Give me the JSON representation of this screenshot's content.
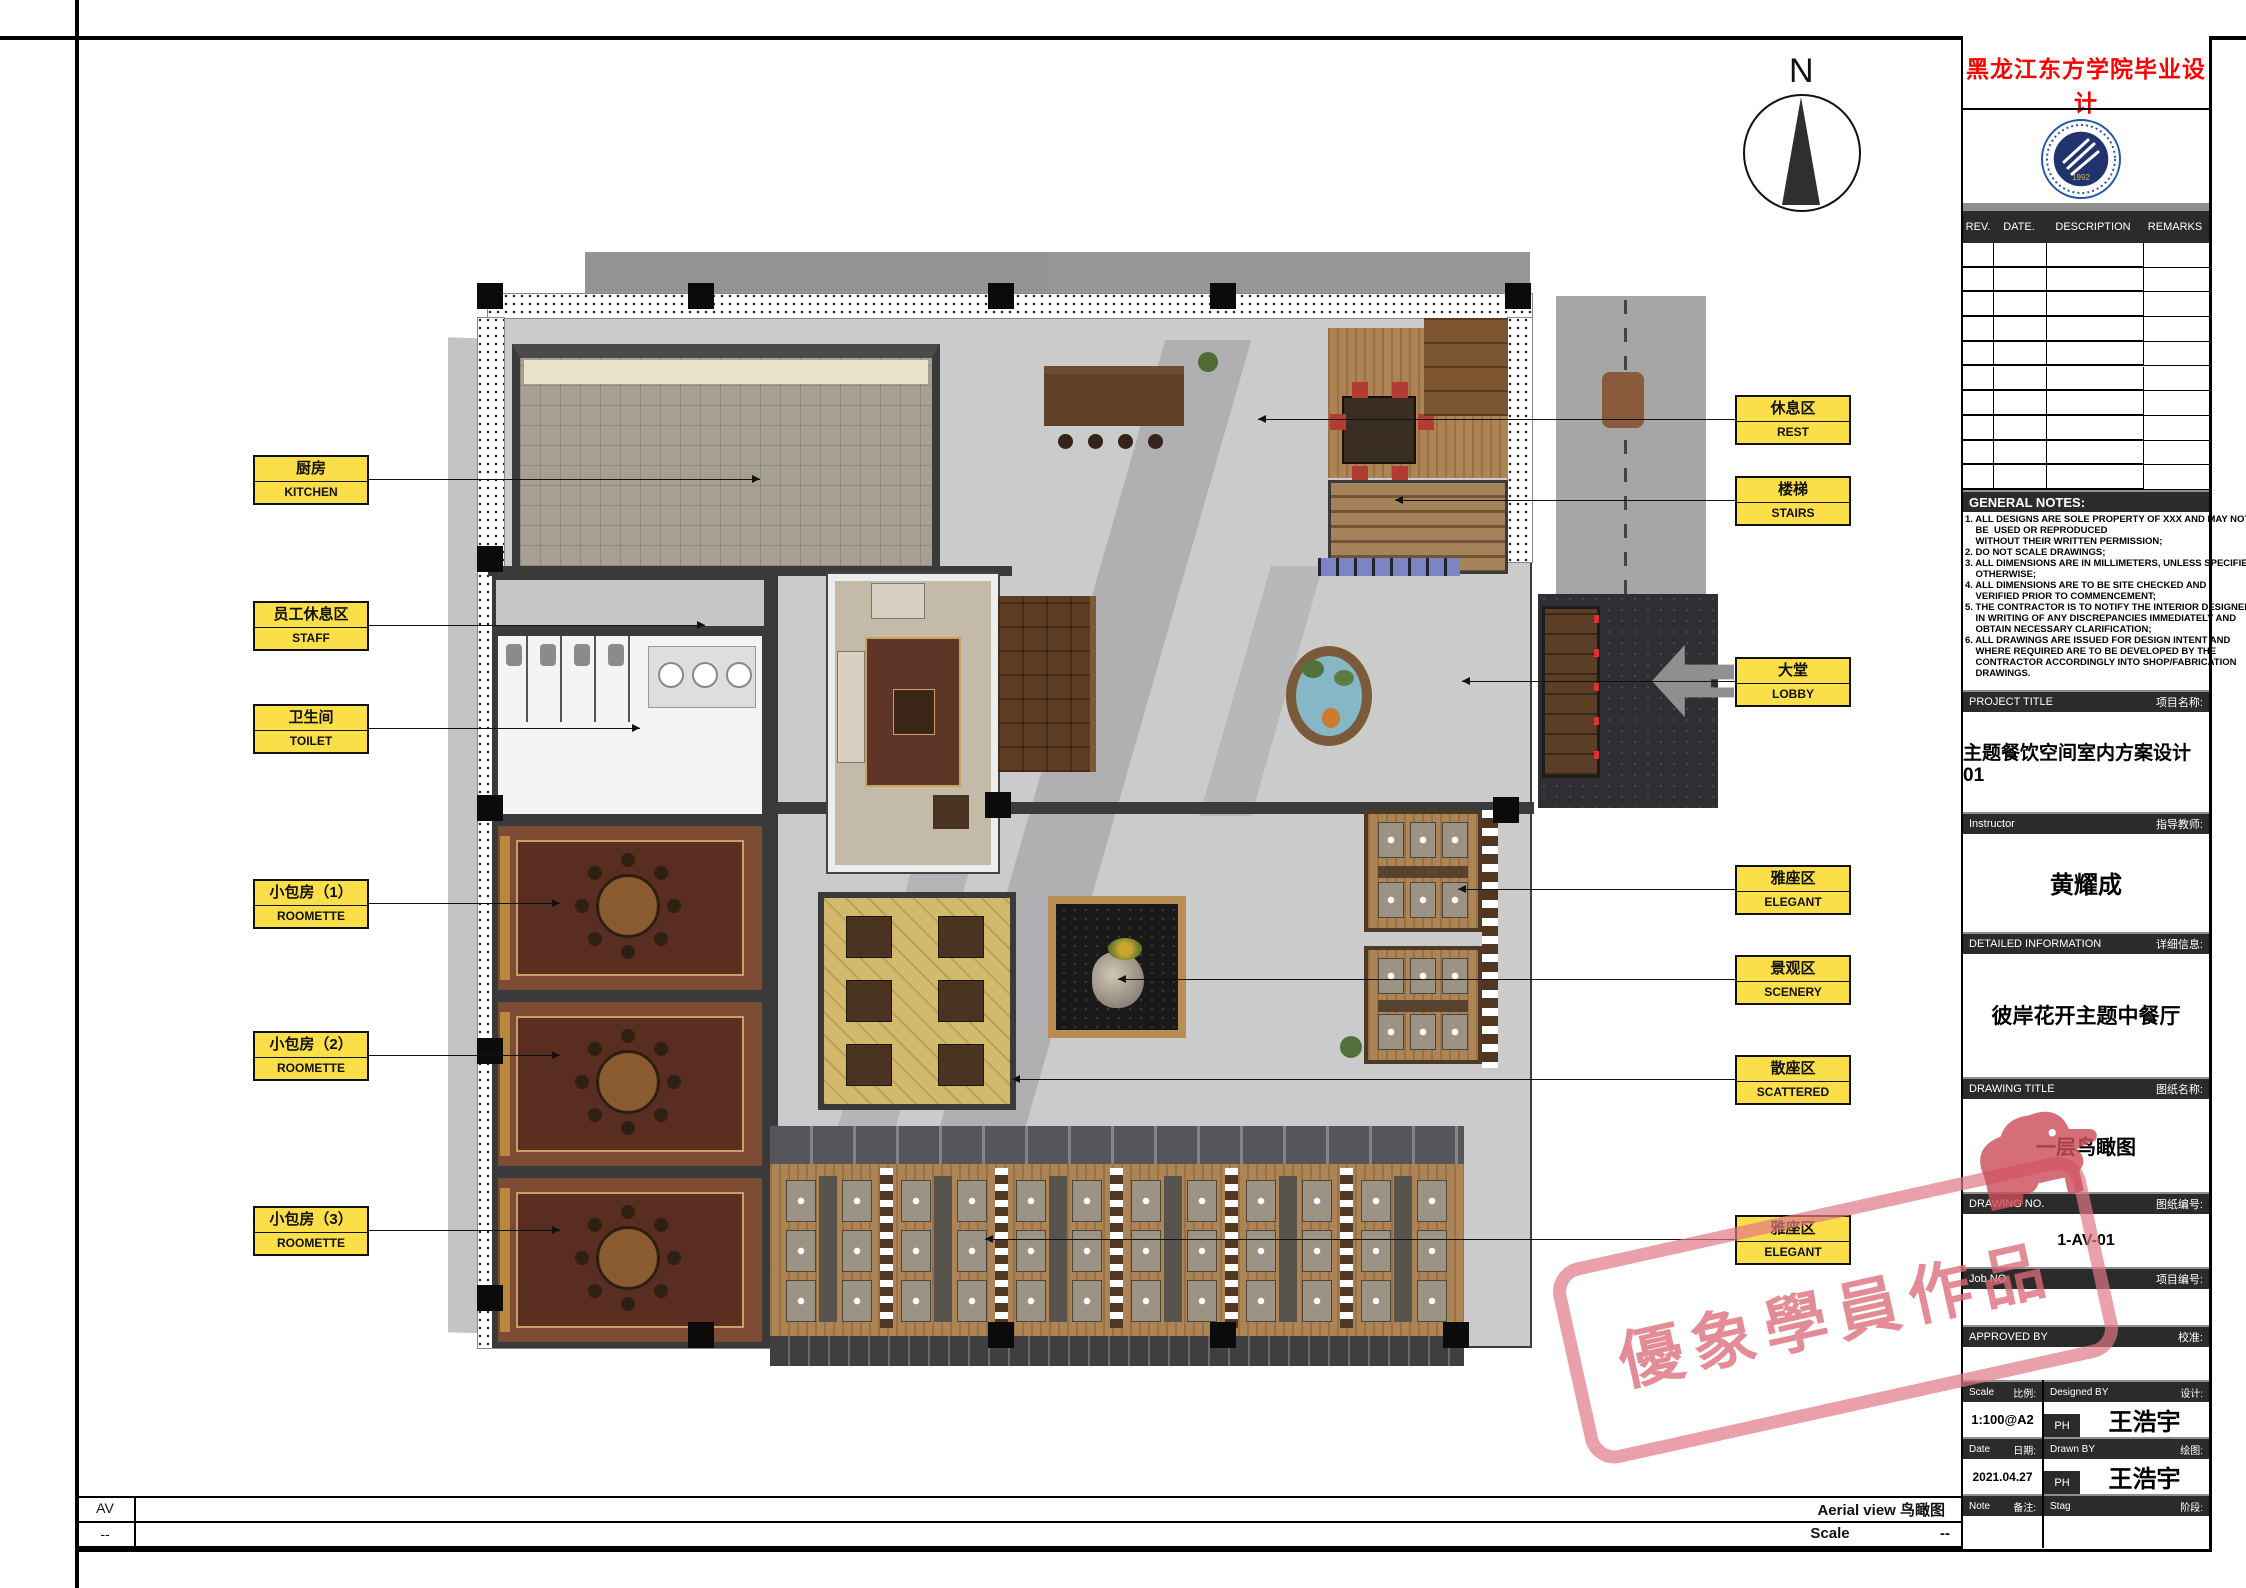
{
  "sheet": {
    "compass_n": "N"
  },
  "watermark": {
    "text": "優象學員作品"
  },
  "footer": {
    "code": "AV",
    "code_row2": "--",
    "view_label": "Aerial view 鸟瞰图",
    "scale_label": "Scale",
    "scale_value": "--"
  },
  "title_block": {
    "school_title": "黑龙江东方学院毕业设计",
    "logo_year": "1992",
    "rev": {
      "rev": "REV.",
      "date": "DATE.",
      "description": "DESCRIPTION",
      "remarks": "REMARKS"
    },
    "notes_title": "GENERAL NOTES:",
    "notes": [
      "1. ALL DESIGNS ARE SOLE PROPERTY OF XXX AND MAY NOT",
      "    BE  USED OR REPRODUCED",
      "    WITHOUT THEIR WRITTEN PERMISSION;",
      "2. DO NOT SCALE DRAWINGS;",
      "3. ALL DIMENSIONS ARE IN MILLIMETERS, UNLESS SPECIFIED",
      "    OTHERWISE;",
      "4. ALL DIMENSIONS ARE TO BE SITE CHECKED AND",
      "    VERIFIED PRIOR TO COMMENCEMENT;",
      "5. THE CONTRACTOR IS TO NOTIFY THE INTERIOR DESIGNER",
      "    IN WRITING OF ANY DISCREPANCIES IMMEDIATELY AND",
      "    OBTAIN NECESSARY CLARIFICATION;",
      "6. ALL DRAWINGS ARE ISSUED FOR DESIGN INTENT AND",
      "    WHERE REQUIRED ARE TO BE DEVELOPED BY THE",
      "    CONTRACTOR ACCORDINGLY INTO SHOP/FABRICATION",
      "    DRAWINGS."
    ],
    "fields": [
      {
        "en": "PROJECT TITLE",
        "zh": "项目名称:",
        "value": "主题餐饮空间室内方案设计01"
      },
      {
        "en": "Instructor",
        "zh": "指导教师:",
        "value": "黄耀成"
      },
      {
        "en": "DETAILED INFORMATION",
        "zh": "详细信息:",
        "value": "彼岸花开主题中餐厅"
      },
      {
        "en": "DRAWING TITLE",
        "zh": "图纸名称:",
        "value": "一层鸟瞰图"
      },
      {
        "en": "DRAWING NO.",
        "zh": "图纸编号:",
        "value": "1-AV-01"
      },
      {
        "en": "Job NO.",
        "zh": "项目编号:",
        "value": ""
      },
      {
        "en": "APPROVED BY",
        "zh": "校准:",
        "value": ""
      }
    ],
    "scale": {
      "en": "Scale",
      "zh": "比例:",
      "value": "1:100@A2"
    },
    "designed": {
      "en": "Designed BY",
      "zh": "设计:",
      "value": "王浩宇",
      "tag": "PH"
    },
    "date": {
      "en": "Date",
      "zh": "日期:",
      "value": "2021.04.27"
    },
    "drawn": {
      "en": "Drawn BY",
      "zh": "绘图:",
      "value": "王浩宇",
      "tag": "PH"
    },
    "note": {
      "en": "Note",
      "zh": "备注:",
      "value": ""
    },
    "stage": {
      "en": "Stag",
      "zh": "阶段:",
      "value": ""
    }
  },
  "plan": {
    "labels_left": [
      {
        "zh": "厨房",
        "en": "KITCHEN",
        "y": 455,
        "to": 760
      },
      {
        "zh": "员工休息区",
        "en": "STAFF",
        "y": 601,
        "to": 705
      },
      {
        "zh": "卫生间",
        "en": "TOILET",
        "y": 704,
        "to": 640
      },
      {
        "zh": "小包房（1）",
        "en": "ROOMETTE",
        "y": 879,
        "to": 560
      },
      {
        "zh": "小包房（2）",
        "en": "ROOMETTE",
        "y": 1031,
        "to": 560
      },
      {
        "zh": "小包房（3）",
        "en": "ROOMETTE",
        "y": 1206,
        "to": 560
      }
    ],
    "labels_right": [
      {
        "zh": "休息区",
        "en": "REST",
        "y": 395,
        "to": 1258
      },
      {
        "zh": "楼梯",
        "en": "STAIRS",
        "y": 476,
        "to": 1395
      },
      {
        "zh": "大堂",
        "en": "LOBBY",
        "y": 657,
        "to": 1462
      },
      {
        "zh": "雅座区",
        "en": "ELEGANT",
        "y": 865,
        "to": 1458
      },
      {
        "zh": "景观区",
        "en": "SCENERY",
        "y": 955,
        "to": 1118
      },
      {
        "zh": "散座区",
        "en": "SCATTERED",
        "y": 1055,
        "to": 1012
      },
      {
        "zh": "雅座区",
        "en": "ELEGANT",
        "y": 1215,
        "to": 985
      }
    ]
  }
}
